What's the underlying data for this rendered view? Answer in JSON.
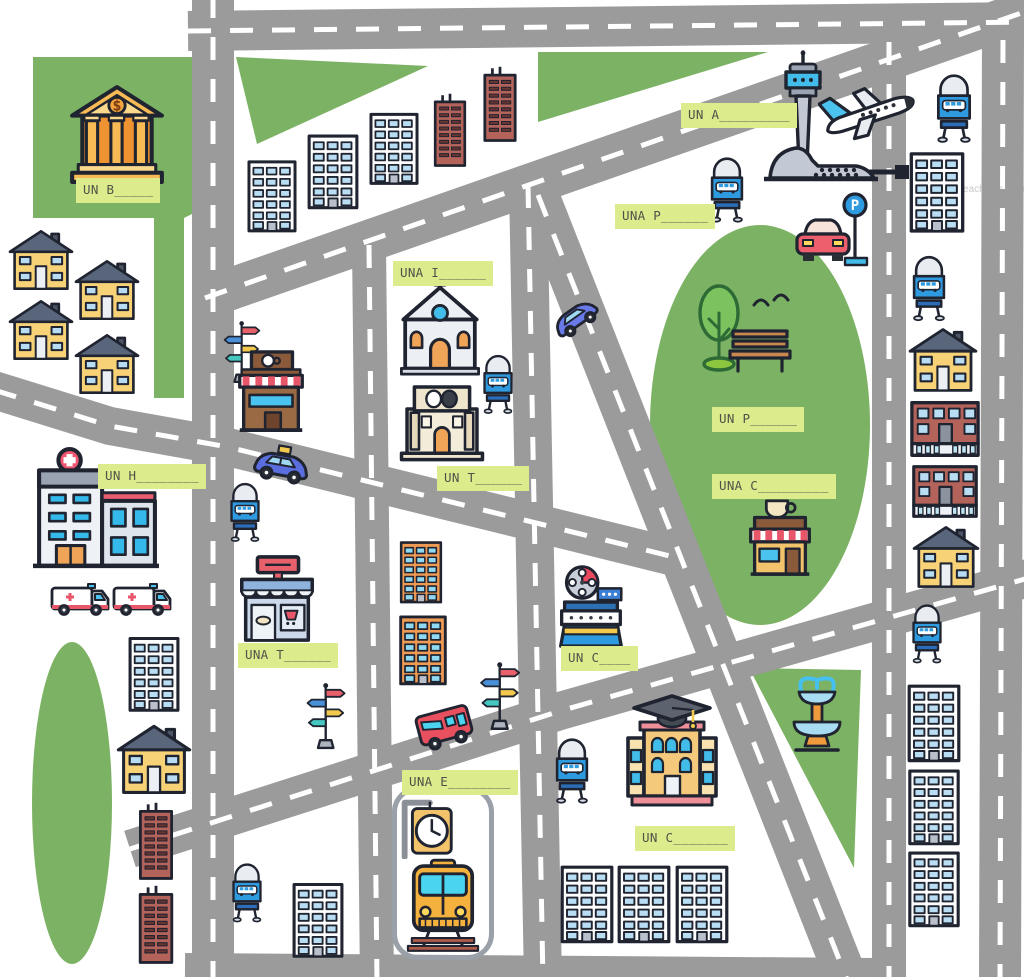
{
  "map": {
    "title": "City map vocabulary worksheet",
    "watermark": "TeachThis.com",
    "signs": {
      "parking_letter": "P",
      "bank_symbol": "$"
    },
    "colors": {
      "road": "#9b9b9b",
      "green": "#7cb264",
      "label_bg": "#dcec8c",
      "label_text": "#50524a",
      "outline": "#1f2430"
    },
    "places": {
      "bank": {
        "label": "UN B_____",
        "icon": "bank-icon"
      },
      "airport": {
        "label": "UN A_________",
        "icon": "airplane-icon"
      },
      "bus_stop": {
        "label": "UNA P______",
        "icon": "bus-stop-sign-icon"
      },
      "church": {
        "label": "UNA I______",
        "icon": "church-icon"
      },
      "theater": {
        "label": "UN T______",
        "icon": "theater-icon"
      },
      "hospital": {
        "label": "UN H________",
        "icon": "hospital-icon"
      },
      "shop": {
        "label": "UNA T______",
        "icon": "shop-icon"
      },
      "park": {
        "label": "UN P______",
        "icon": "park-icon"
      },
      "coffee_shop": {
        "label": "UNA C_________",
        "icon": "coffee-shop-icon"
      },
      "cinema": {
        "label": "UN C____",
        "icon": "cinema-icon"
      },
      "train_station": {
        "label": "UNA E________",
        "icon": "train-station-icon"
      },
      "school": {
        "label": "UN C_______",
        "icon": "school-icon"
      }
    },
    "street_items": [
      "bus-stop-sign-icon",
      "street-signpost-icon",
      "taxi-icon",
      "car-icon",
      "bus-icon",
      "ambulance-icon",
      "parking-sign-icon",
      "fountain-icon",
      "tree-icon",
      "bench-icon",
      "birds-icon",
      "station-clock-icon",
      "control-tower-icon",
      "airport-terminal-icon",
      "house-icon",
      "apartment-building-icon",
      "brick-tower-icon",
      "brick-building-icon"
    ]
  }
}
